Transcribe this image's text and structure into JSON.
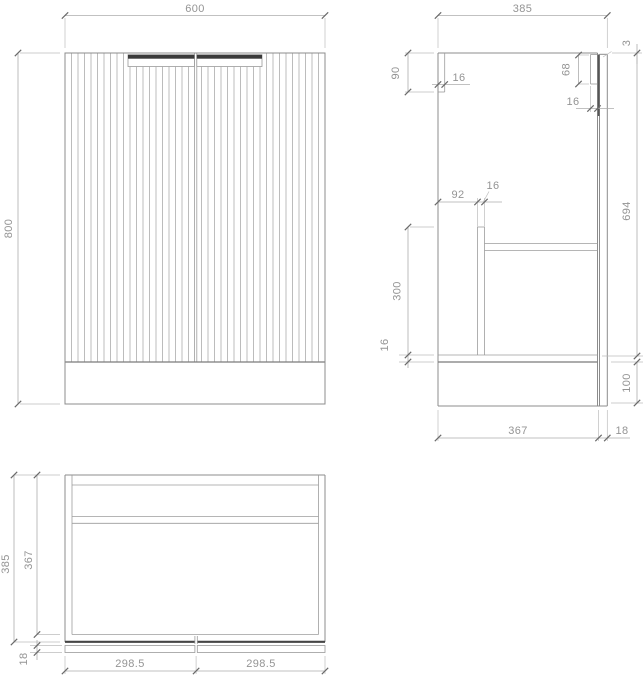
{
  "drawing": {
    "type": "technical-drawing",
    "subject": "fluted two-door vanity cabinet, three orthographic views",
    "line_color": "#8c8c8c",
    "accent_dark": "#3a3a3a",
    "dims": {
      "front": {
        "width": "600",
        "height": "800"
      },
      "side": {
        "overall_depth": "385",
        "top_gap": "3",
        "back_rail_height": "90",
        "back_rail_thickness": "16",
        "front_rail_height": "68",
        "front_rail_thickness": "16",
        "divider_setback": "92",
        "divider_thickness": "16",
        "divider_height": "300",
        "bottom_panel_thickness": "16",
        "carcass_height": "694",
        "plinth_height": "100",
        "body_depth": "367",
        "door_thickness": "18"
      },
      "plan": {
        "overall_depth": "385",
        "body_depth": "367",
        "door_thickness": "18",
        "door_left_width": "298.5",
        "door_right_width": "298.5"
      }
    }
  }
}
